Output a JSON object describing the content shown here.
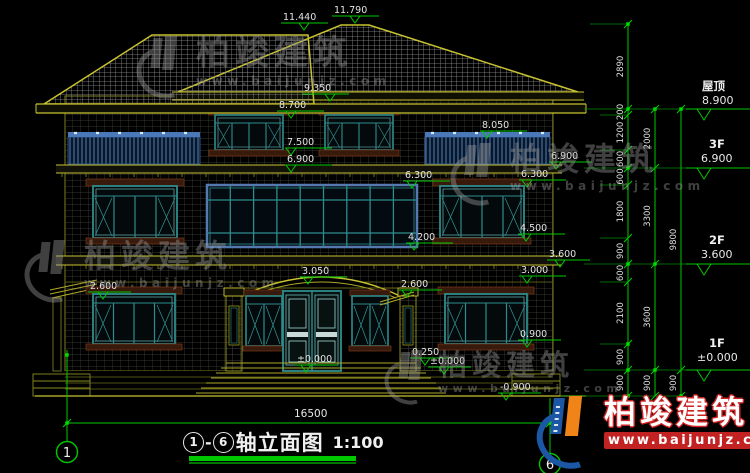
{
  "drawing": {
    "title": {
      "axis_start": "1",
      "separator": "-",
      "axis_end": "6",
      "name": "轴立面图",
      "scale": "1:100"
    },
    "bottom_width_dim": "16500",
    "axis_bubble_left": "1",
    "axis_bubble_right": "6"
  },
  "levels": [
    {
      "label": "屋顶",
      "value": "8.900"
    },
    {
      "label": "3F",
      "value": "6.900"
    },
    {
      "label": "2F",
      "value": "3.600"
    },
    {
      "label": "1F",
      "value": "±0.000"
    }
  ],
  "marks": [
    {
      "value": "11.440"
    },
    {
      "value": "11.790"
    },
    {
      "value": "9.350"
    },
    {
      "value": "8.700"
    },
    {
      "value": "7.500"
    },
    {
      "value": "6.900"
    },
    {
      "value": "8.050"
    },
    {
      "value": "6.900"
    },
    {
      "value": "6.300"
    },
    {
      "value": "6.300"
    },
    {
      "value": "4.200"
    },
    {
      "value": "4.500"
    },
    {
      "value": "3.600"
    },
    {
      "value": "3.050"
    },
    {
      "value": "3.000"
    },
    {
      "value": "2.600"
    },
    {
      "value": "2.600"
    },
    {
      "value": "0.900"
    },
    {
      "value": "0.250"
    },
    {
      "value": "±0.000"
    },
    {
      "value": "±0.000"
    },
    {
      "value": "-0.900"
    }
  ],
  "chains": {
    "inner": [
      "2890",
      "200",
      "1200",
      "600",
      "600",
      "1800",
      "900",
      "600",
      "2100",
      "900",
      "900"
    ],
    "middle": [
      "2000",
      "3300",
      "3600",
      "900"
    ],
    "outer": [
      "9800",
      "900"
    ]
  },
  "watermark": {
    "brand": "柏竣建筑",
    "url": "www.baijunjz.com"
  },
  "colors": {
    "dim_green": "#00c800",
    "line_yellow": "#c8c230",
    "window_teal": "#2e8c8c",
    "railing_blue": "#3f6ea8",
    "logo_blue": "#1c57a5",
    "logo_orange": "#f08418",
    "logo_red": "#c32222"
  }
}
